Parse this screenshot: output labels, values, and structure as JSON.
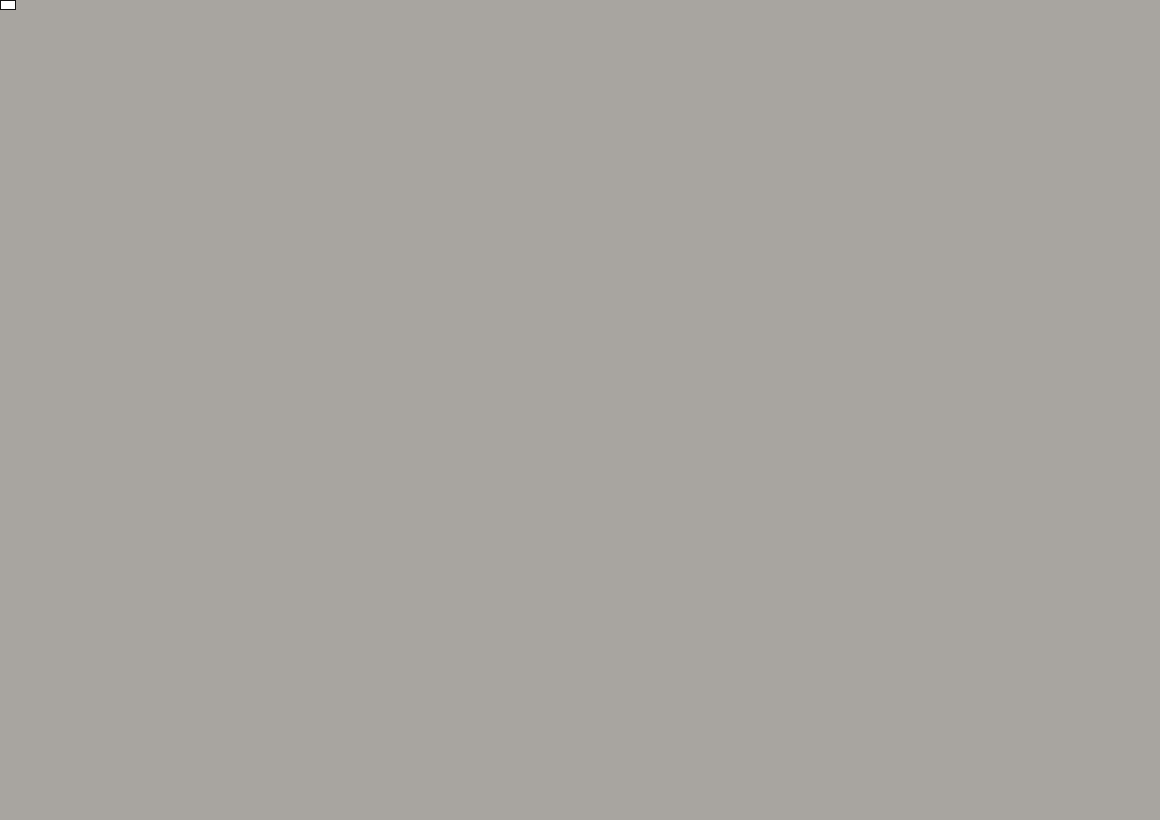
{
  "colors": {
    "building_pink": "#c48b8b",
    "building_white": "#eeece7",
    "building_salmon": "#fc9f97",
    "road_fill": "#bdbbb6",
    "road_lane": "#9e9c97",
    "barrier_red": "#c42128",
    "sign_blue": "#1a57a8",
    "sign_red": "#c42128",
    "leader_black": "#1b1b1b"
  },
  "callouts": [
    {
      "label": "Standort Höhe Ravensbergerstraße",
      "x": 378,
      "y": 28
    },
    {
      "label": "Standort Höhe Mönchstr. 57",
      "x": 389,
      "y": 66
    }
  ],
  "leader_lines": [
    [
      656,
      41,
      704,
      27
    ],
    [
      603,
      79,
      758,
      69
    ],
    [
      603,
      87,
      712,
      110
    ]
  ],
  "annotations": [
    {
      "text": "Parkscheinautomat abdecken!",
      "x": 517,
      "y": 738,
      "rot": -4
    },
    {
      "text": "MEERESKUNDEMUSEUM",
      "x": 330,
      "y": 765,
      "rot": -24
    }
  ],
  "street_labels": [
    {
      "text": "Heilgeiststraße",
      "x": 95,
      "y": 107,
      "rot": 9,
      "size": 11
    },
    {
      "text": "Heilgeiststraße",
      "x": 196,
      "y": 124,
      "rot": 12,
      "size": 11
    },
    {
      "text": "Heilgeiststraße",
      "x": 512,
      "y": 196,
      "rot": 10,
      "size": 9.5
    },
    {
      "text": "Heilgeiststraße",
      "x": 941,
      "y": 226,
      "rot": -9,
      "size": 11
    },
    {
      "text": "Mühlenstraße",
      "x": 187,
      "y": 62,
      "rot": 80,
      "size": 11
    },
    {
      "text": "Mönchstraße",
      "x": 736,
      "y": 122,
      "rot": 87,
      "size": 11
    },
    {
      "text": "Mönchstraße",
      "x": 719,
      "y": 478,
      "rot": 88,
      "size": 11
    },
    {
      "text": "Mönchstraße",
      "x": 733,
      "y": 762,
      "rot": 85,
      "size": 11
    },
    {
      "text": "Bielkenhagen",
      "x": 284,
      "y": 422,
      "rot": 84,
      "size": 11
    },
    {
      "text": "Bielkenhagen",
      "x": 537,
      "y": 694,
      "rot": -4,
      "size": 11
    },
    {
      "text": "Bielkenhagen",
      "x": 172,
      "y": 729,
      "rot": -9,
      "size": 10
    },
    {
      "text": "Böttcherstraße",
      "x": 1020,
      "y": 799,
      "rot": -6,
      "size": 11
    }
  ],
  "buildings": [
    {
      "n": "",
      "x": 60,
      "y": 20,
      "w": 150,
      "h": 70,
      "r": -10,
      "c": "p",
      "lr": 0
    },
    {
      "n": "5",
      "x": 22,
      "y": 112,
      "w": 52,
      "h": 112,
      "r": 12,
      "c": "p",
      "lr": -60
    },
    {
      "n": "96",
      "x": 85,
      "y": 62,
      "w": 92,
      "h": 78,
      "r": -15,
      "c": "w",
      "lr": -72
    },
    {
      "n": "26",
      "x": 152,
      "y": 45,
      "w": 118,
      "h": 88,
      "r": -12,
      "c": "w",
      "lr": -85
    },
    {
      "n": "28",
      "x": 276,
      "y": 28,
      "w": 96,
      "h": 52,
      "r": -10,
      "c": "p",
      "lr": -80
    },
    {
      "n": "95",
      "x": 281,
      "y": 78,
      "w": 92,
      "h": 58,
      "r": -10,
      "c": "p",
      "lr": -82
    },
    {
      "n": "28",
      "x": 347,
      "y": 16,
      "w": 58,
      "h": 36,
      "r": -12,
      "c": "w",
      "lr": -80
    },
    {
      "n": "94",
      "x": 401,
      "y": 19,
      "w": 54,
      "h": 40,
      "r": -12,
      "c": "w",
      "lr": -85
    },
    {
      "n": "18",
      "x": 547,
      "y": 21,
      "w": 68,
      "h": 44,
      "r": -25,
      "c": "w",
      "lr": -30
    },
    {
      "n": "94",
      "x": 506,
      "y": 132,
      "w": 182,
      "h": 96,
      "r": -9,
      "c": "w",
      "lr": 187
    },
    {
      "n": "18",
      "x": 681,
      "y": 16,
      "w": 64,
      "h": 38,
      "r": -12,
      "c": "p",
      "lr": 160
    },
    {
      "n": "18",
      "x": 667,
      "y": 50,
      "w": 56,
      "h": 40,
      "r": -10,
      "c": "p",
      "lr": 78
    },
    {
      "n": "19",
      "x": 659,
      "y": 102,
      "w": 70,
      "h": 52,
      "r": -8,
      "c": "p",
      "lr": 150
    },
    {
      "n": "20",
      "x": 630,
      "y": 152,
      "w": 148,
      "h": 108,
      "r": -9,
      "c": "p",
      "lr": 166,
      "lx": 628,
      "ly": 155
    },
    {
      "n": "2",
      "x": 76,
      "y": 206,
      "w": 136,
      "h": 96,
      "r": -3,
      "c": "w",
      "lr": 0
    },
    {
      "n": "4",
      "x": 44,
      "y": 261,
      "w": 32,
      "h": 30,
      "r": 0,
      "c": "w",
      "lr": 0
    },
    {
      "n": "1",
      "x": 179,
      "y": 200,
      "w": 78,
      "h": 92,
      "r": -18,
      "c": "p",
      "lr": 62
    },
    {
      "n": "5",
      "x": 411,
      "y": 243,
      "w": 132,
      "h": 96,
      "r": -10,
      "c": "p",
      "lr": -70
    },
    {
      "n": "6",
      "x": 494,
      "y": 280,
      "w": 74,
      "h": 96,
      "r": -10,
      "c": "p",
      "lr": -70,
      "lx": 500,
      "ly": 276
    },
    {
      "n": "7",
      "x": 553,
      "y": 273,
      "w": 58,
      "h": 96,
      "r": -9,
      "c": "p",
      "lr": -64,
      "lx": 551,
      "ly": 271
    },
    {
      "n": "8",
      "x": 613,
      "y": 291,
      "w": 58,
      "h": 100,
      "r": -7,
      "c": "p",
      "lr": -80,
      "lx": 612,
      "ly": 284
    },
    {
      "n": "21",
      "x": 663,
      "y": 293,
      "w": 44,
      "h": 106,
      "r": -4,
      "c": "p",
      "lr": -86,
      "lx": 660,
      "ly": 291
    },
    {
      "n": "22",
      "x": 546,
      "y": 346,
      "w": 86,
      "h": 58,
      "r": -20,
      "c": "w",
      "lr": -60,
      "lx": 542,
      "ly": 343
    },
    {
      "n": "22",
      "x": 657,
      "y": 357,
      "w": 92,
      "h": 68,
      "r": -20,
      "c": "p",
      "lr": -78,
      "lx": 631,
      "ly": 348
    },
    {
      "n": "23",
      "x": 592,
      "y": 442,
      "w": 155,
      "h": 155,
      "r": -11,
      "c": "p",
      "lr": 74,
      "lx": 565,
      "ly": 440
    },
    {
      "n": "",
      "x": 603,
      "y": 516,
      "w": 76,
      "h": 44,
      "r": -8,
      "c": "w",
      "lr": 0
    },
    {
      "n": "",
      "x": 592,
      "y": 586,
      "w": 92,
      "h": 92,
      "r": -5,
      "c": "w",
      "lr": 0
    },
    {
      "n": "6",
      "x": 333,
      "y": 331,
      "w": 64,
      "h": 76,
      "r": -10,
      "c": "w",
      "lr": 100
    },
    {
      "n": "5C",
      "x": 346,
      "y": 381,
      "w": 64,
      "h": 40,
      "r": 32,
      "c": "p",
      "lr": 32
    },
    {
      "n": "5B",
      "x": 354,
      "y": 416,
      "w": 64,
      "h": 40,
      "r": 34,
      "c": "p",
      "lr": 34
    },
    {
      "n": "5A",
      "x": 364,
      "y": 449,
      "w": 64,
      "h": 40,
      "r": 35,
      "c": "p",
      "lr": 35
    },
    {
      "n": "5",
      "x": 432,
      "y": 541,
      "w": 150,
      "h": 112,
      "r": -8,
      "c": "w",
      "lr": 188,
      "lx": 433,
      "ly": 538
    },
    {
      "n": "1",
      "x": 458,
      "y": 622,
      "w": 232,
      "h": 122,
      "r": -10,
      "c": "w",
      "lr": 64,
      "lx": 430,
      "ly": 623
    },
    {
      "n": "9",
      "x": 93,
      "y": 347,
      "w": 34,
      "h": 28,
      "r": 0,
      "c": "w",
      "lr": 0
    },
    {
      "n": "8",
      "x": 106,
      "y": 431,
      "w": 150,
      "h": 146,
      "r": -15,
      "c": "s",
      "lr": 58,
      "lx": 88,
      "ly": 418
    },
    {
      "n": "9",
      "x": 102,
      "y": 491,
      "w": 172,
      "h": 36,
      "r": -17,
      "c": "s",
      "lr": 74,
      "lx": 116,
      "ly": 492
    },
    {
      "n": "6",
      "x": 108,
      "y": 521,
      "w": 180,
      "h": 38,
      "r": -17,
      "c": "s",
      "lr": 76,
      "lx": 126,
      "ly": 518
    },
    {
      "n": "",
      "x": 100,
      "y": 632,
      "w": 192,
      "h": 142,
      "r": -14,
      "c": "s",
      "lr": 0
    },
    {
      "n": "10",
      "x": 201,
      "y": 786,
      "w": 118,
      "h": 76,
      "r": -14,
      "c": "s",
      "lr": 58,
      "lx": 195,
      "ly": 787
    },
    {
      "n": "9",
      "x": 835,
      "y": 302,
      "w": 132,
      "h": 88,
      "r": 10,
      "c": "p",
      "lr": 170,
      "lx": 818,
      "ly": 313
    },
    {
      "n": "10",
      "x": 882,
      "y": 288,
      "w": 58,
      "h": 82,
      "r": 15,
      "c": "p",
      "lr": 155,
      "lx": 886,
      "ly": 281
    },
    {
      "n": "11",
      "x": 934,
      "y": 284,
      "w": 54,
      "h": 76,
      "r": 18,
      "c": "p",
      "lr": 150,
      "lx": 935,
      "ly": 277
    },
    {
      "n": "12",
      "x": 1001,
      "y": 291,
      "w": 82,
      "h": 86,
      "r": 15,
      "c": "p",
      "lr": 155,
      "lx": 1000,
      "ly": 288
    },
    {
      "n": "13",
      "x": 1070,
      "y": 281,
      "w": 76,
      "h": 86,
      "r": 12,
      "c": "p",
      "lr": 160,
      "lx": 1067,
      "ly": 274
    },
    {
      "n": "14",
      "x": 1131,
      "y": 271,
      "w": 70,
      "h": 86,
      "r": 10,
      "c": "p",
      "lr": 165,
      "lx": 1125,
      "ly": 266
    },
    {
      "n": "14",
      "x": 1129,
      "y": 391,
      "w": 56,
      "h": 96,
      "r": 5,
      "c": "p",
      "lr": 95,
      "lx": 1131,
      "ly": 383
    },
    {
      "n": "50",
      "x": 822,
      "y": 396,
      "w": 96,
      "h": 66,
      "r": 12,
      "c": "p",
      "lr": 160,
      "lx": 817,
      "ly": 392
    },
    {
      "n": "50",
      "x": 926,
      "y": 376,
      "w": 100,
      "h": 60,
      "r": 20,
      "c": "p",
      "lr": 205,
      "lx": 920,
      "ly": 373
    },
    {
      "n": "49A",
      "x": 816,
      "y": 459,
      "w": 100,
      "h": 56,
      "r": 12,
      "c": "p",
      "lr": 155,
      "lx": 812,
      "ly": 456
    },
    {
      "n": "49A",
      "x": 894,
      "y": 464,
      "w": 50,
      "h": 72,
      "r": 20,
      "c": "p",
      "lr": 65,
      "lx": 893,
      "ly": 461
    },
    {
      "n": "49",
      "x": 952,
      "y": 501,
      "w": 132,
      "h": 60,
      "r": 12,
      "c": "p",
      "lr": 188,
      "lx": 960,
      "ly": 496
    },
    {
      "n": "49",
      "x": 832,
      "y": 526,
      "w": 112,
      "h": 60,
      "r": 10,
      "c": "p",
      "lr": 170,
      "lx": 820,
      "ly": 521
    },
    {
      "n": "48",
      "x": 832,
      "y": 591,
      "w": 122,
      "h": 76,
      "r": 10,
      "c": "p",
      "lr": 170,
      "lx": 827,
      "ly": 590
    },
    {
      "n": "47",
      "x": 816,
      "y": 651,
      "w": 96,
      "h": 72,
      "r": 12,
      "c": "p",
      "lr": 160,
      "lx": 808,
      "ly": 647
    },
    {
      "n": "46",
      "x": 806,
      "y": 736,
      "w": 96,
      "h": 112,
      "r": 8,
      "c": "p",
      "lr": 160,
      "lx": 802,
      "ly": 742
    },
    {
      "n": "39",
      "x": 856,
      "y": 764,
      "w": 56,
      "h": 60,
      "r": 10,
      "c": "p",
      "lr": 76,
      "lx": 857,
      "ly": 762
    },
    {
      "n": "36",
      "x": 931,
      "y": 753,
      "w": 122,
      "h": 70,
      "r": 5,
      "c": "p",
      "lr": 178,
      "lx": 925,
      "ly": 751
    },
    {
      "n": "35",
      "x": 1041,
      "y": 726,
      "w": 122,
      "h": 112,
      "r": 10,
      "c": "p",
      "lr": 115,
      "lx": 1036,
      "ly": 731
    },
    {
      "n": "34",
      "x": 1129,
      "y": 711,
      "w": 82,
      "h": 100,
      "r": 8,
      "c": "w",
      "lr": 80,
      "lx": 1125,
      "ly": 706
    },
    {
      "n": "93",
      "x": 801,
      "y": 101,
      "w": 92,
      "h": 76,
      "r": 15,
      "c": "p",
      "lr": 167,
      "lx": 792,
      "ly": 93
    },
    {
      "n": "93",
      "x": 806,
      "y": 166,
      "w": 86,
      "h": 60,
      "r": 15,
      "c": "p",
      "lr": 167,
      "lx": 803,
      "ly": 164
    },
    {
      "n": "92",
      "x": 886,
      "y": 63,
      "w": 40,
      "h": 62,
      "r": 8,
      "c": "p",
      "lr": 95,
      "lx": 885,
      "ly": 62
    },
    {
      "n": "92",
      "x": 888,
      "y": 101,
      "w": 40,
      "h": 46,
      "r": 8,
      "c": "p",
      "lr": 95,
      "lx": 887,
      "ly": 100
    },
    {
      "n": "92",
      "x": 869,
      "y": 161,
      "w": 62,
      "h": 76,
      "r": 10,
      "c": "p",
      "lr": 115,
      "lx": 866,
      "ly": 160
    },
    {
      "n": "91",
      "x": 931,
      "y": 136,
      "w": 62,
      "h": 96,
      "r": 10,
      "c": "p",
      "lr": 170,
      "lx": 928,
      "ly": 133
    },
    {
      "n": "90",
      "x": 1001,
      "y": 41,
      "w": 62,
      "h": 72,
      "r": 5,
      "c": "p",
      "lr": 100,
      "lx": 998,
      "ly": 37
    },
    {
      "n": "90",
      "x": 991,
      "y": 129,
      "w": 66,
      "h": 96,
      "r": 8,
      "c": "p",
      "lr": 162,
      "lx": 990,
      "ly": 125
    },
    {
      "n": "89",
      "x": 1059,
      "y": 101,
      "w": 72,
      "h": 100,
      "r": 8,
      "c": "p",
      "lr": 168,
      "lx": 1056,
      "ly": 96
    },
    {
      "n": "88",
      "x": 1129,
      "y": 81,
      "w": 76,
      "h": 106,
      "r": 5,
      "c": "p",
      "lr": 160,
      "lx": 1125,
      "ly": 75
    },
    {
      "n": "",
      "x": 1152,
      "y": 760,
      "w": 70,
      "h": 120,
      "r": 8,
      "c": "p",
      "lr": 0
    },
    {
      "n": "",
      "x": 990,
      "y": 822,
      "w": 260,
      "h": 40,
      "r": -7,
      "c": "p",
      "lr": 0
    }
  ],
  "extra_labels": [
    {
      "text": "23",
      "x": 588,
      "y": 513,
      "rot": 15
    },
    {
      "text": "23",
      "x": 618,
      "y": 513,
      "rot": 0
    },
    {
      "text": "24",
      "x": 577,
      "y": 571,
      "rot": 0
    },
    {
      "text": "24",
      "x": 599,
      "y": 601,
      "rot": 76
    },
    {
      "text": "9",
      "x": 114,
      "y": 563,
      "rot": 74
    },
    {
      "text": "9",
      "x": 139,
      "y": 638,
      "rot": 58
    }
  ],
  "signs": [
    {
      "type": "north_arrow",
      "x": 14,
      "y": 10
    },
    {
      "type": "dead_end",
      "x": 290,
      "y": 160,
      "rot": -15
    },
    {
      "type": "dead_end",
      "x": 727,
      "y": 27,
      "rot": 3
    },
    {
      "type": "no_entry_crossed",
      "x": 707,
      "y": 61
    },
    {
      "type": "no_entry_crossed",
      "x": 771,
      "y": 70
    },
    {
      "type": "no_vehicles",
      "x": 508,
      "y": 193,
      "r": 16
    },
    {
      "type": "no_vehicles",
      "x": 729,
      "y": 152,
      "r": 14
    },
    {
      "type": "no_vehicles",
      "x": 716,
      "y": 246,
      "r": 14
    },
    {
      "type": "no_stopping",
      "x": 757,
      "y": 304,
      "arrow": "right"
    },
    {
      "type": "no_stopping",
      "x": 354,
      "y": 670,
      "arrow": "down"
    },
    {
      "type": "no_stopping",
      "x": 660,
      "y": 643,
      "arrow": "up"
    },
    {
      "type": "no_stopping",
      "x": 760,
      "y": 718,
      "arrow": "up"
    },
    {
      "type": "crossed_panel",
      "x": 214,
      "y": 176,
      "w": 20,
      "h": 36,
      "bg": "white"
    },
    {
      "type": "crossed_panel",
      "x": 266,
      "y": 176,
      "w": 20,
      "h": 36,
      "bg": "white"
    },
    {
      "type": "crossed_panel",
      "x": 345,
      "y": 691,
      "w": 20,
      "h": 26,
      "bg": "white"
    },
    {
      "type": "crossed_panel",
      "x": 367,
      "y": 691,
      "w": 24,
      "h": 26,
      "bg": "gray"
    },
    {
      "type": "crossed_panel",
      "x": 394,
      "y": 690,
      "w": 20,
      "h": 26,
      "bg": "white"
    },
    {
      "type": "crossed_panel",
      "x": 414,
      "y": 690,
      "w": 24,
      "h": 26,
      "bg": "gray"
    },
    {
      "type": "crossed_panel",
      "x": 652,
      "y": 664,
      "w": 16,
      "h": 22,
      "bg": "white"
    },
    {
      "type": "crossed_panel",
      "x": 669,
      "y": 664,
      "w": 16,
      "h": 22,
      "bg": "gray"
    },
    {
      "type": "crossed_circle",
      "x": 690,
      "y": 712,
      "r": 13
    },
    {
      "type": "anlieger_panel",
      "x": 785,
      "y": 303,
      "w": 27,
      "h": 40
    },
    {
      "type": "p_arrow_panel",
      "x": 785,
      "y": 339,
      "w": 25,
      "h": 27
    },
    {
      "type": "stripe_panel",
      "x": 785,
      "y": 361,
      "w": 25,
      "h": 11
    },
    {
      "type": "p_arrow_panel",
      "x": 763,
      "y": 745,
      "w": 23,
      "h": 27
    },
    {
      "type": "stripe_panel",
      "x": 763,
      "y": 764,
      "w": 22,
      "h": 11
    }
  ],
  "barriers": [
    {
      "pts": [
        697,
        126,
        756,
        136
      ],
      "style": "redwhite"
    },
    {
      "pts": [
        489,
        164,
        492,
        218
      ],
      "style": "reddash"
    },
    {
      "pts": [
        491,
        221,
        567,
        238
      ],
      "style": "redwhite"
    },
    {
      "pts": [
        766,
        213,
        691,
        307
      ],
      "style": "redwhite"
    },
    {
      "pts": [
        688,
        309,
        680,
        320
      ],
      "style": "reddash"
    }
  ]
}
